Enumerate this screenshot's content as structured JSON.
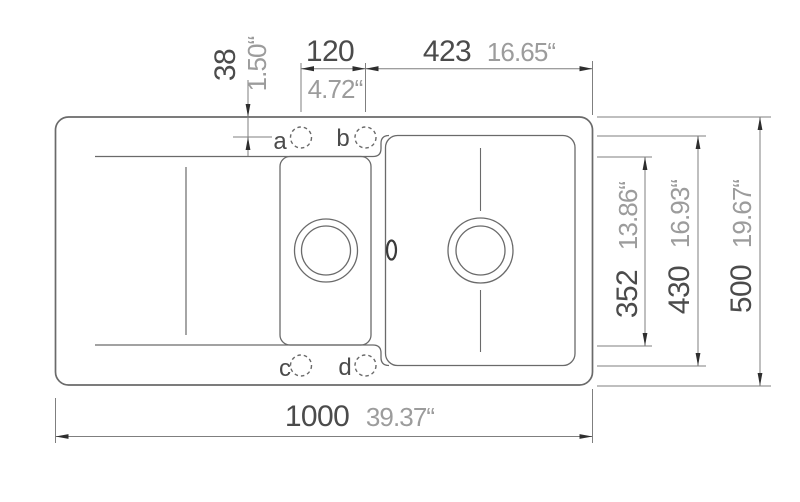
{
  "drawing": {
    "dimensions": {
      "overall_width": {
        "mm": "1000",
        "inch": "39.37“"
      },
      "overall_depth": {
        "mm": "500",
        "inch": "19.67“"
      },
      "large_bowl_depth": {
        "mm": "430",
        "inch": "16.93“"
      },
      "small_bowl_depth": {
        "mm": "352",
        "inch": "13.86“"
      },
      "taphole_to_right_edge": {
        "mm": "423",
        "inch": "16.65“"
      },
      "taphole_spacing": {
        "mm": "120",
        "inch": "4.72“"
      },
      "taphole_to_top_edge": {
        "mm": "38",
        "inch": "1.50“"
      }
    },
    "tap_holes": {
      "a": "a",
      "b": "b",
      "c": "c",
      "d": "d"
    },
    "colors": {
      "outline": "#6a6a6a",
      "thin_line": "#7f7f7f",
      "arrow": "#2e2e2e",
      "mm_text": "#4b4b4b",
      "inch_text": "#9c9c9c"
    }
  }
}
